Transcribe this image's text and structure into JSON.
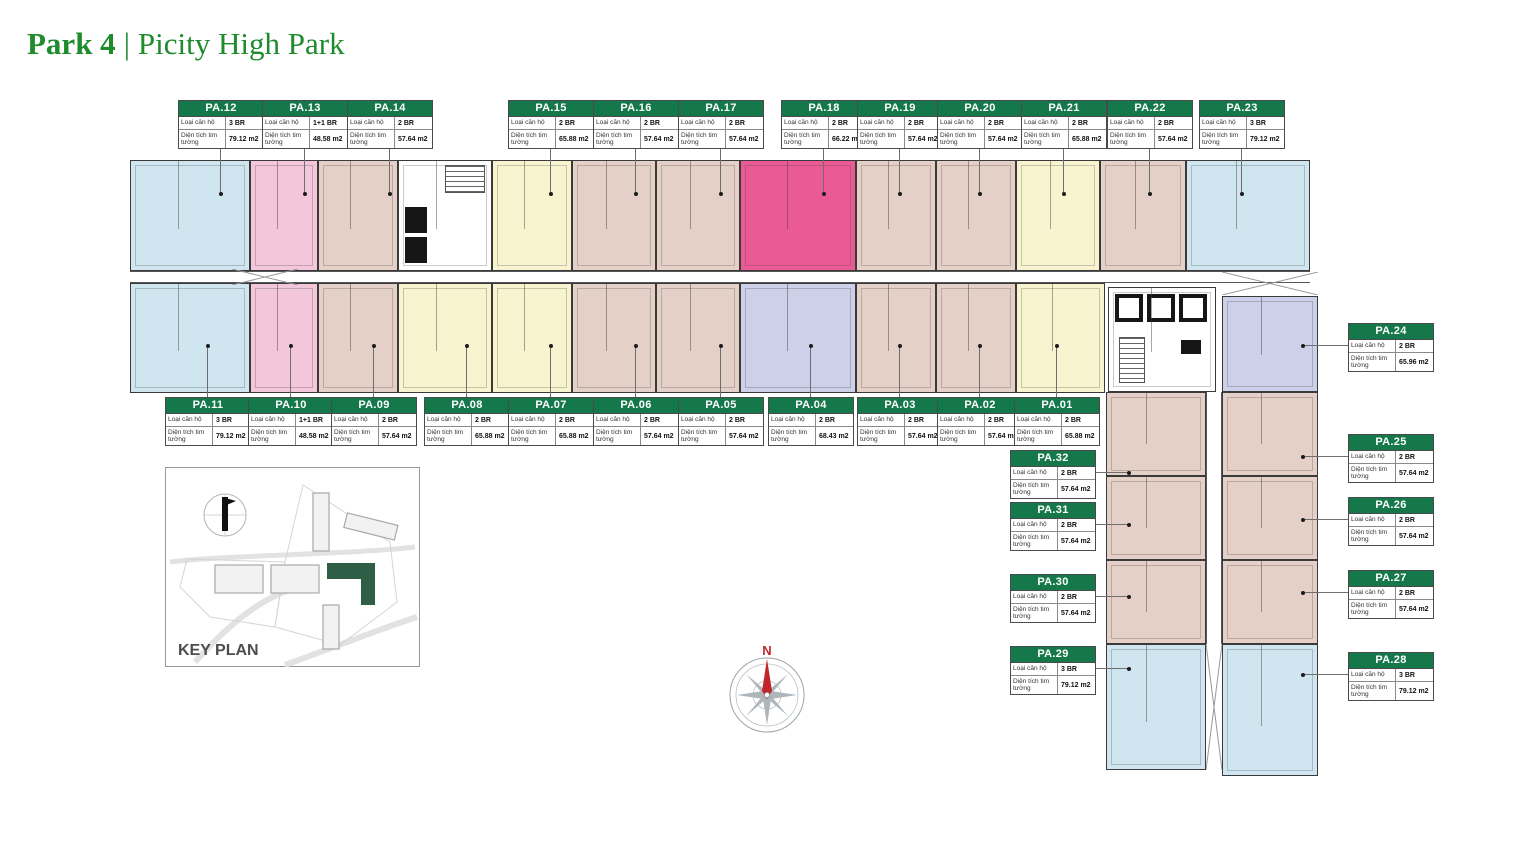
{
  "title": {
    "part1": "Park 4",
    "divider": "|",
    "part2": "Picity High Park"
  },
  "strings": {
    "type_label": "Loại căn hộ",
    "area_label": "Diện tích tim tường",
    "key_plan": "KEY PLAN",
    "compass_north": "N"
  },
  "colors": {
    "header_green": "#15784a",
    "title_green": "#1e8b2d",
    "unit_3br_blue": "#cfe6f0",
    "unit_1plus1_pink": "#f3c6da",
    "unit_2br_tan": "#e5d0c8",
    "unit_2br_yellow": "#f8f4d0",
    "unit_2br_magenta": "#ea5b96",
    "unit_2br_lavender": "#ccd0e8",
    "keyplan_highlight_green": "#2e5e46",
    "compass_red": "#c0272d"
  },
  "units": [
    {
      "id": "PA.01",
      "type": "2 BR",
      "area": "65.88 m2"
    },
    {
      "id": "PA.02",
      "type": "2 BR",
      "area": "57.64 m2"
    },
    {
      "id": "PA.03",
      "type": "2 BR",
      "area": "57.64 m2"
    },
    {
      "id": "PA.04",
      "type": "2 BR",
      "area": "68.43 m2"
    },
    {
      "id": "PA.05",
      "type": "2 BR",
      "area": "57.64 m2"
    },
    {
      "id": "PA.06",
      "type": "2 BR",
      "area": "57.64 m2"
    },
    {
      "id": "PA.07",
      "type": "2 BR",
      "area": "65.88 m2"
    },
    {
      "id": "PA.08",
      "type": "2 BR",
      "area": "65.88 m2"
    },
    {
      "id": "PA.09",
      "type": "2 BR",
      "area": "57.64 m2"
    },
    {
      "id": "PA.10",
      "type": "1+1 BR",
      "area": "48.58 m2"
    },
    {
      "id": "PA.11",
      "type": "3 BR",
      "area": "79.12 m2"
    },
    {
      "id": "PA.12",
      "type": "3 BR",
      "area": "79.12 m2"
    },
    {
      "id": "PA.13",
      "type": "1+1 BR",
      "area": "48.58 m2"
    },
    {
      "id": "PA.14",
      "type": "2 BR",
      "area": "57.64 m2"
    },
    {
      "id": "PA.15",
      "type": "2 BR",
      "area": "65.88 m2"
    },
    {
      "id": "PA.16",
      "type": "2 BR",
      "area": "57.64 m2"
    },
    {
      "id": "PA.17",
      "type": "2 BR",
      "area": "57.64 m2"
    },
    {
      "id": "PA.18",
      "type": "2 BR",
      "area": "66.22 m2"
    },
    {
      "id": "PA.19",
      "type": "2 BR",
      "area": "57.64 m2"
    },
    {
      "id": "PA.20",
      "type": "2 BR",
      "area": "57.64 m2"
    },
    {
      "id": "PA.21",
      "type": "2 BR",
      "area": "65.88 m2"
    },
    {
      "id": "PA.22",
      "type": "2 BR",
      "area": "57.64 m2"
    },
    {
      "id": "PA.23",
      "type": "3 BR",
      "area": "79.12 m2"
    },
    {
      "id": "PA.24",
      "type": "2 BR",
      "area": "65.96 m2"
    },
    {
      "id": "PA.25",
      "type": "2 BR",
      "area": "57.64 m2"
    },
    {
      "id": "PA.26",
      "type": "2 BR",
      "area": "57.64 m2"
    },
    {
      "id": "PA.27",
      "type": "2 BR",
      "area": "57.64 m2"
    },
    {
      "id": "PA.28",
      "type": "3 BR",
      "area": "79.12 m2"
    },
    {
      "id": "PA.29",
      "type": "3 BR",
      "area": "79.12 m2"
    },
    {
      "id": "PA.30",
      "type": "2 BR",
      "area": "57.64 m2"
    },
    {
      "id": "PA.31",
      "type": "2 BR",
      "area": "57.64 m2"
    },
    {
      "id": "PA.32",
      "type": "2 BR",
      "area": "57.64 m2"
    }
  ]
}
